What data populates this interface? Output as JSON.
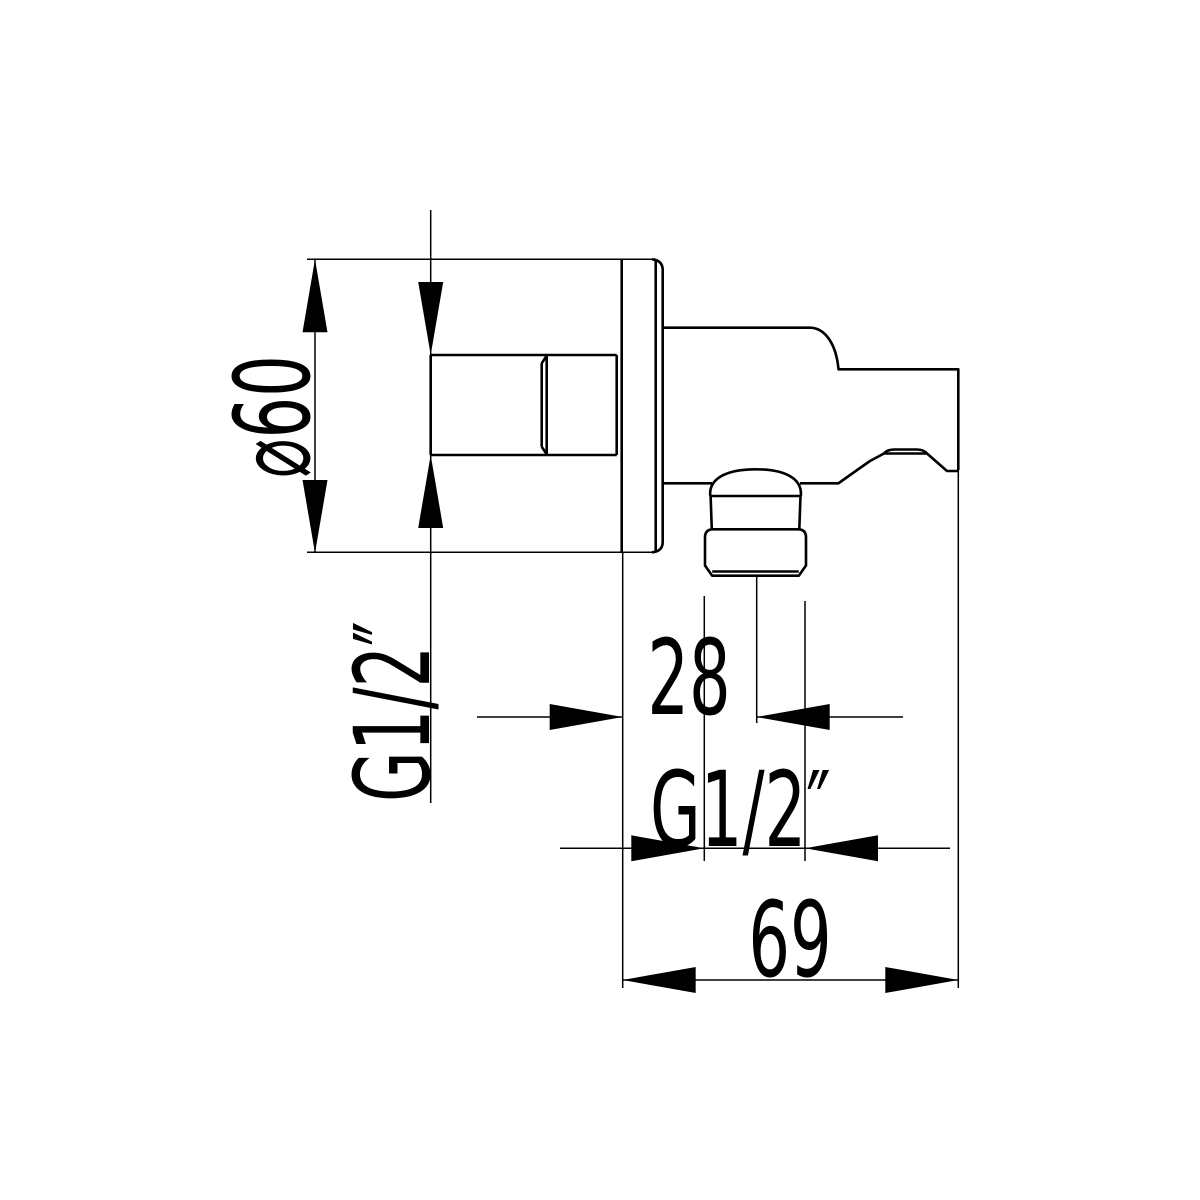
{
  "colors": {
    "ink": "#000000",
    "background": "#ffffff"
  },
  "drawing": {
    "type": "technical-dimension-drawing",
    "subject": "wall shower outlet elbow with handset holder, side view",
    "dimensions": {
      "escutcheon_diameter": "⌀60",
      "inlet_thread": "G1/2″",
      "outlet_offset": "28",
      "outlet_thread": "G1/2″",
      "overall_depth": "69"
    }
  }
}
